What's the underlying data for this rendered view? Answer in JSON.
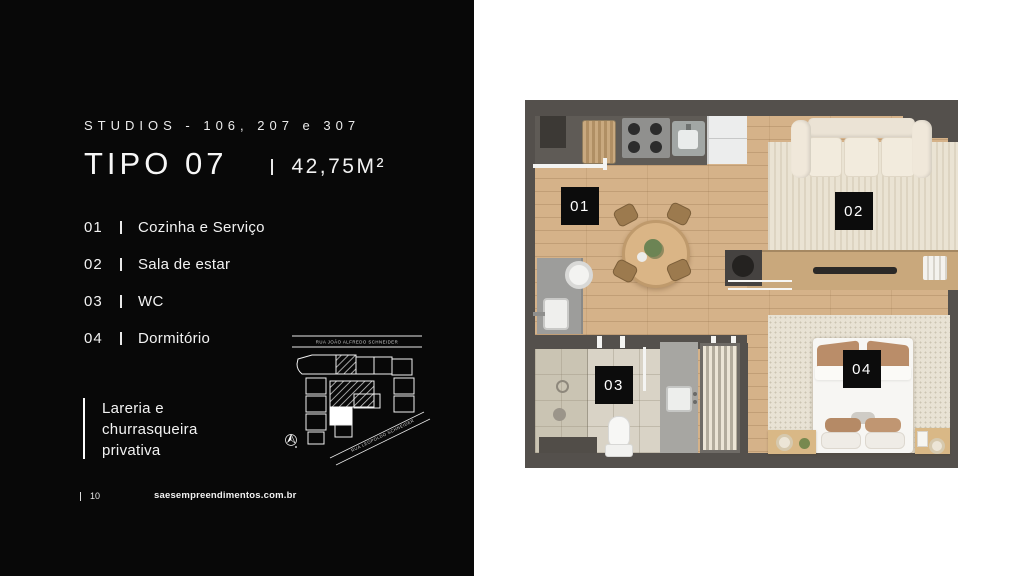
{
  "panel": {
    "eyebrow": "STUDIOS - 106, 207 e 307",
    "type_title": "TIPO 07",
    "area": "42,75M²",
    "rooms": [
      {
        "num": "01",
        "name": "Cozinha e Serviço"
      },
      {
        "num": "02",
        "name": "Sala de estar"
      },
      {
        "num": "03",
        "name": "WC"
      },
      {
        "num": "04",
        "name": "Dormitório"
      }
    ],
    "callout_lines": [
      "Lareria e",
      "churrasqueira",
      "privativa"
    ],
    "sitemap": {
      "street_top": "RUA JOÃO ALFREDO SCHNEIDER",
      "street_diagonal": "RUA LEOPOLDO SCHNEIDER"
    },
    "footer": {
      "page": "10",
      "website": "saesempreendimentos.com.br"
    }
  },
  "floorplan": {
    "labels": [
      "01",
      "02",
      "03",
      "04"
    ]
  },
  "colors": {
    "panel_bg": "#080808",
    "canvas_bg": "#ffffff",
    "wall": "#54504c",
    "wood_floor": "#d5b289",
    "label_bg": "#0c0c0c"
  }
}
